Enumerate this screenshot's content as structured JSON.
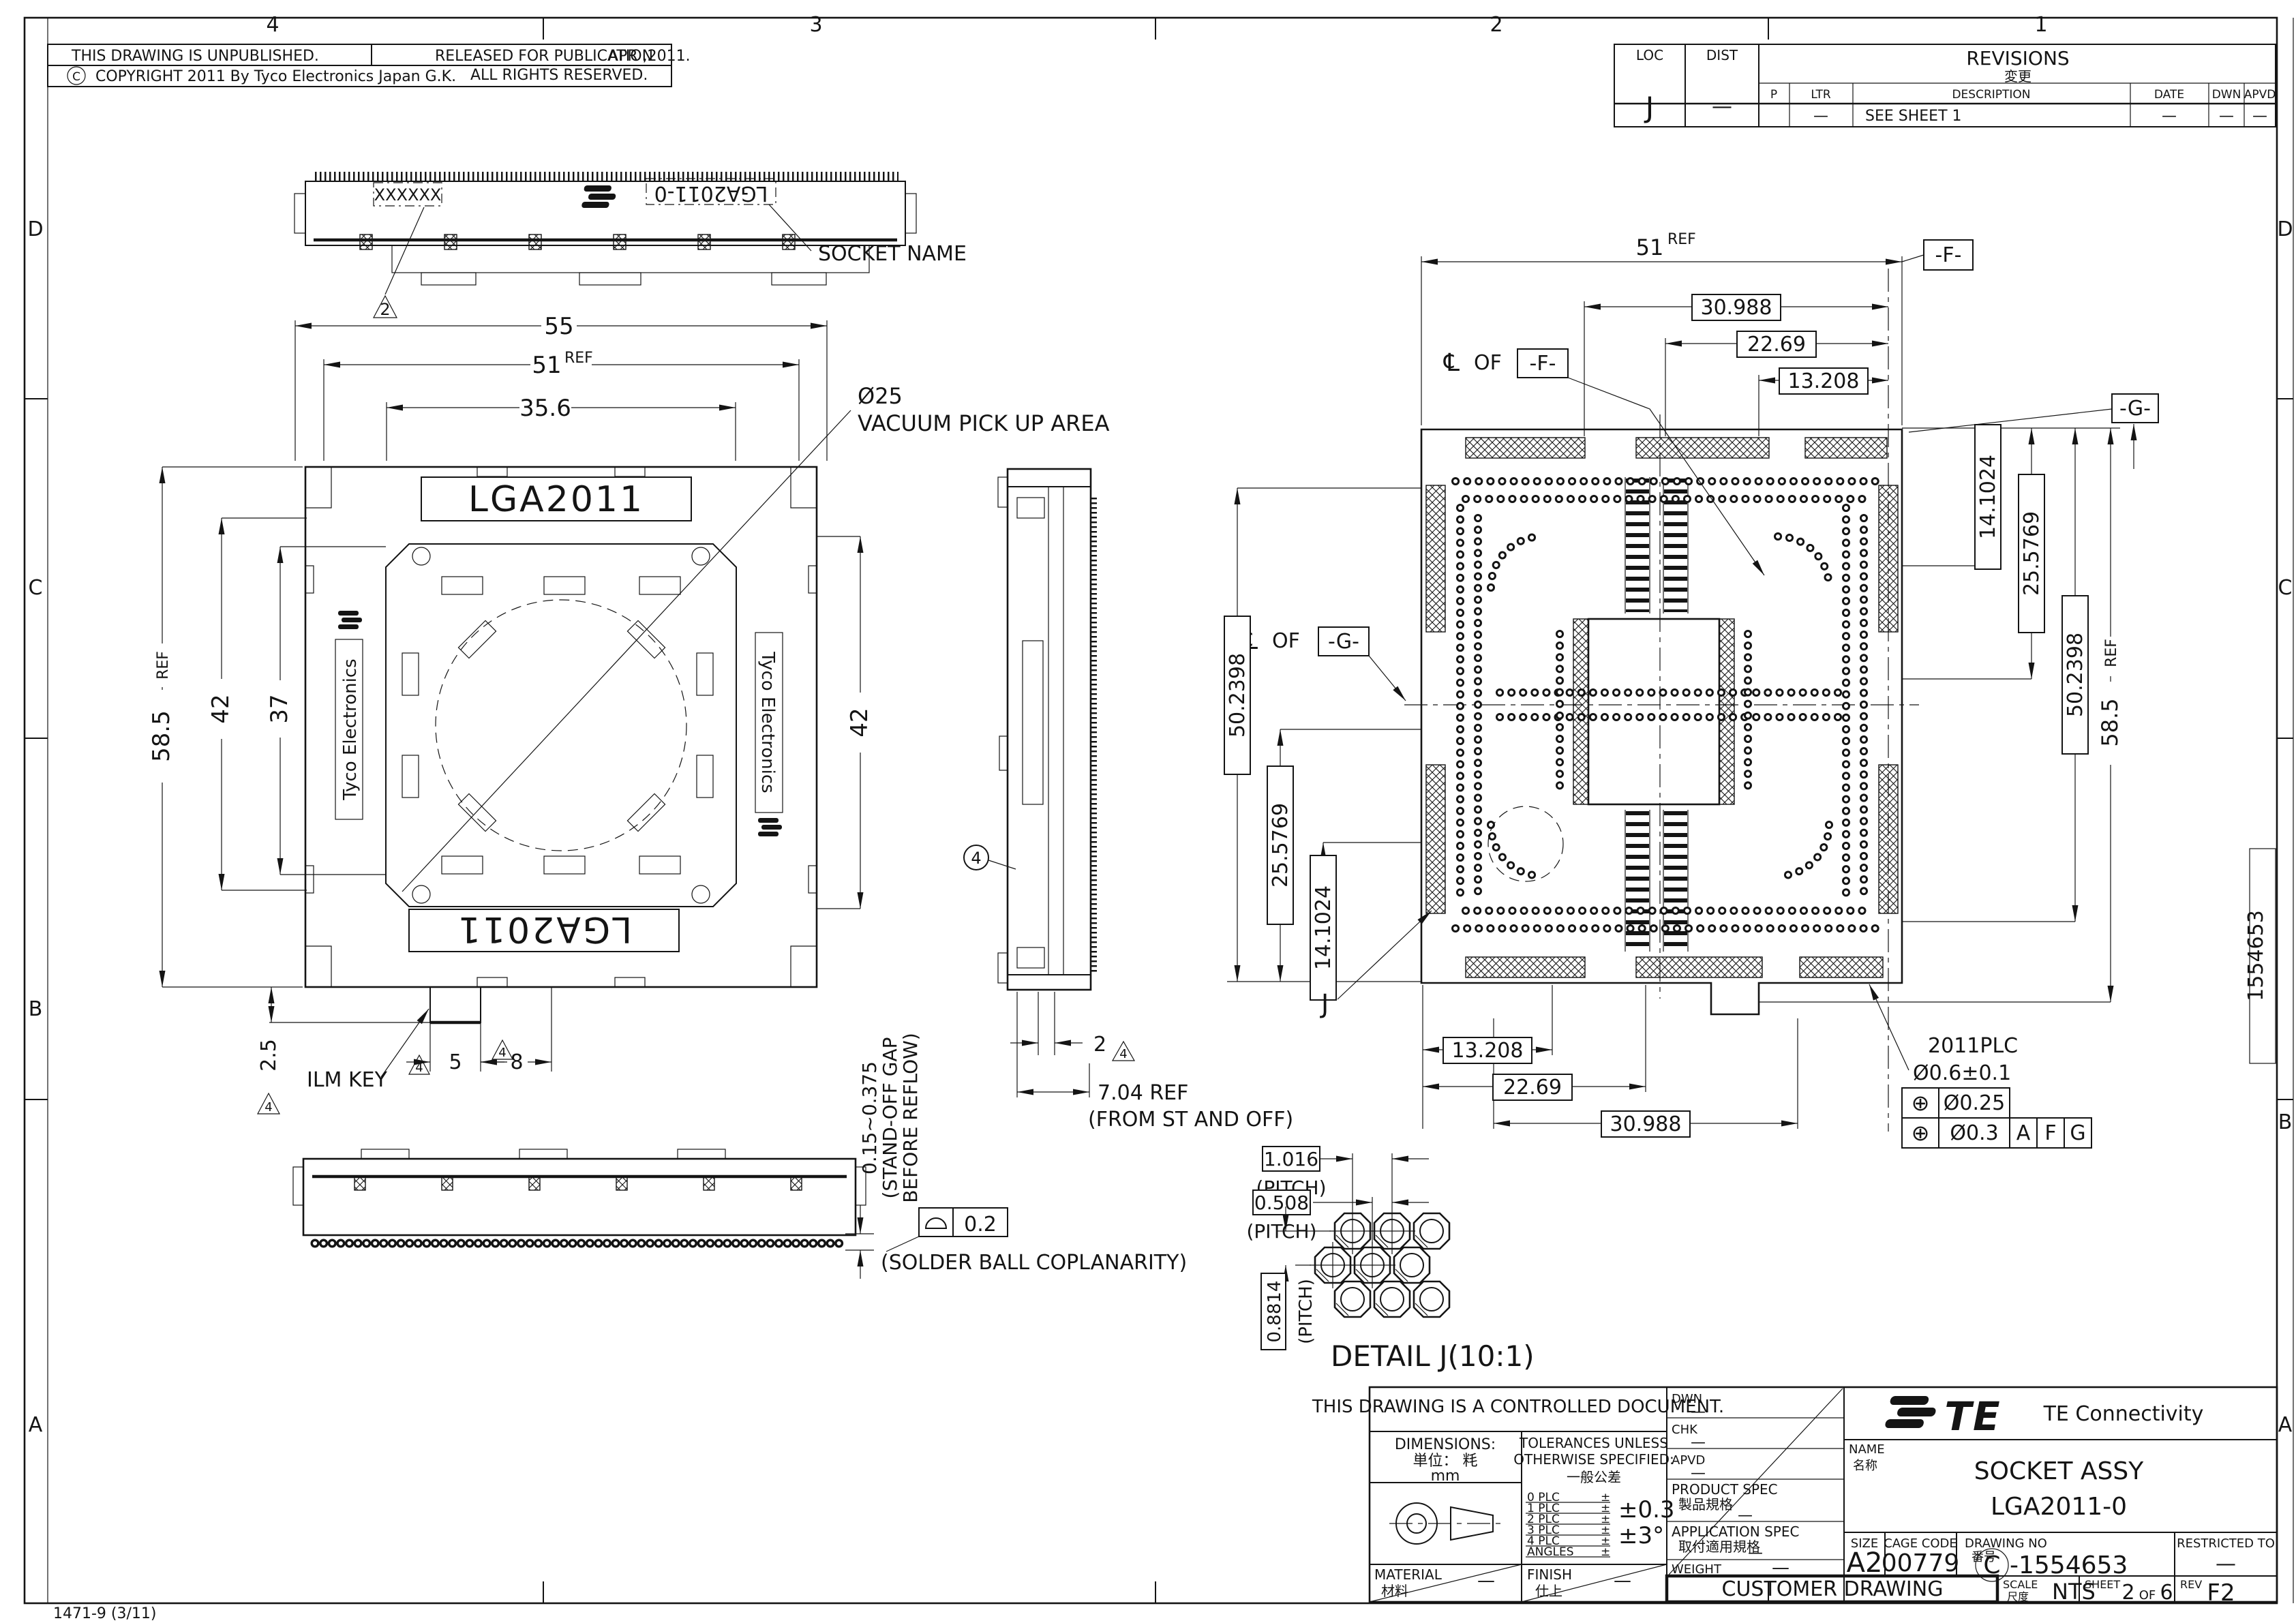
{
  "frame": {
    "zones_top": [
      "4",
      "3",
      "2",
      "1"
    ],
    "zones_left": [
      "D",
      "C",
      "B",
      "A"
    ],
    "zones_right": [
      "D",
      "C",
      "B",
      "A"
    ],
    "footer_code": "1471-9  (3/11)",
    "margin_number": "1554653"
  },
  "header": {
    "unpublished": "THIS DRAWING IS UNPUBLISHED.",
    "released": "RELEASED FOR PUBLICATION",
    "date": "APR ,2011.",
    "copyright_symbol": "C",
    "copyright": "COPYRIGHT  2011  By Tyco Electronics Japan G.K.",
    "rights": "ALL RIGHTS RESERVED."
  },
  "revisions": {
    "loc_label": "LOC",
    "loc_value": "J",
    "dist_label": "DIST",
    "dist_value": "—",
    "title": "REVISIONS",
    "title_jp": "変更",
    "col_p": "P",
    "col_ltr": "LTR",
    "col_description": "DESCRIPTION",
    "col_date": "DATE",
    "col_dwn": "DWN",
    "col_apvd": "APVD",
    "row_ltr": "—",
    "row_description": "SEE SHEET 1",
    "row_date": "—",
    "row_dwn": "—",
    "row_apvd": "—"
  },
  "views": {
    "marking": {
      "mark_x": "XXXXXX",
      "mark_name": "LGA2011-0",
      "socket_name_label": "SOCKET NAME",
      "note2": "2"
    },
    "front": {
      "dim_overall_w": "55",
      "dim_body_w": "51",
      "ref": "REF",
      "dim_pick_w": "35.6",
      "pick_dia": "Ø25",
      "pick_label": "VACUUM PICK UP AREA",
      "lga": "LGA2011",
      "brand": "Tyco Electronics",
      "dim_overall_h": "58.5",
      "dim_h1": "42",
      "dim_h2": "37",
      "dim_right_h": "42",
      "ilm_key": "ILM KEY",
      "dim_key_h": "2.5",
      "dim_key_w1": "5",
      "dim_key_w2": "8",
      "note4": "4"
    },
    "side": {
      "balloon4": "4",
      "dim_pin": "2",
      "note4": "4",
      "dim_standoff": "7.04 REF",
      "dim_standoff_note": "(FROM ST AND OFF)"
    },
    "reflow": {
      "standoff_range": "0.15~0.375",
      "standoff_note1": "(STAND-OFF GAP",
      "standoff_note2": "BEFORE REFLOW)",
      "coplanarity": "0.2",
      "coplanarity_note": "(SOLDER BALL COPLANARITY)"
    },
    "bottom": {
      "dim_w": "51",
      "ref": "REF",
      "datum_f": "-F-",
      "datum_g": "-G-",
      "cl": "℄",
      "of": "OF",
      "dim_t1": "30.988",
      "dim_t2": "22.69",
      "dim_t3": "13.208",
      "dim_l1": "50.2398",
      "dim_l2": "25.5769",
      "dim_l3": "14.1024",
      "dim_r1": "14.1024",
      "dim_r2": "25.5769",
      "dim_r3": "50.2398",
      "dim_r4": "58.5",
      "dim_b1": "13.208",
      "dim_b2": "22.69",
      "dim_b3": "30.988",
      "plc": "2011PLC",
      "hole": "Ø0.6±0.1",
      "pos_sym": "⊕",
      "tol1": "Ø0.25",
      "tol2": "Ø0.3",
      "d_a": "A",
      "d_f": "F",
      "d_g": "G",
      "detail_ref": "J"
    },
    "detail_j": {
      "p1": "1.016",
      "p2": "0.508",
      "p3": "0.8814",
      "pitch": "(PITCH)",
      "title": "DETAIL J(10:1)"
    }
  },
  "title_block": {
    "controlled": "THIS DRAWING IS A CONTROLLED DOCUMENT.",
    "dims_label": "DIMENSIONS:",
    "dims_jp": "単位： 粍",
    "dims_unit": "mm",
    "tol1": "TOLERANCES UNLESS",
    "tol2": "OTHERWISE SPECIFIED:",
    "tol_jp": "一般公差",
    "tol_rows": [
      {
        "label": "0 PLC",
        "pm": "±"
      },
      {
        "label": "1 PLC",
        "pm": "±"
      },
      {
        "label": "2 PLC",
        "pm": "±"
      },
      {
        "label": "3 PLC",
        "pm": "±"
      },
      {
        "label": "4 PLC",
        "pm": "±"
      },
      {
        "label": "ANGLES",
        "pm": "±"
      }
    ],
    "tol_v1": "±0.3",
    "tol_v2": "±3°",
    "material_label": "MATERIAL",
    "material_jp": "材料",
    "material_value": "—",
    "finish_label": "FINISH",
    "finish_jp": "仕上",
    "finish_value": "—",
    "dwn_label": "DWN",
    "dwn_value": "—",
    "chk_label": "CHK",
    "chk_value": "—",
    "apvd_label": "APVD",
    "apvd_value": "—",
    "product_label": "PRODUCT SPEC",
    "product_jp": "製品規格",
    "product_value": "—",
    "application_label": "APPLICATION SPEC",
    "application_jp": "取付適用規格",
    "application_value": "—",
    "weight_label": "WEIGHT",
    "weight_value": "—",
    "customer_drawing": "CUSTOMER DRAWING",
    "logo_text": "TE",
    "brand": "TE  Connectivity",
    "name_label": "NAME",
    "name_jp": "名称",
    "name_line1": "SOCKET ASSY",
    "name_line2": "LGA2011-0",
    "size_label": "SIZE",
    "size_value": "A2",
    "cage_label": "CAGE CODE",
    "cage_value": "00779",
    "dwg_label": "DRAWING NO",
    "dwg_jp": "番号",
    "dwg_prefix": "C",
    "dwg_value": "-1554653",
    "restricted_label": "RESTRICTED TO",
    "restricted_value": "—",
    "scale_label": "SCALE",
    "scale_jp": "尺度",
    "scale_value": "NTS",
    "sheet_label": "SHEET",
    "sheet_no": "2",
    "sheet_of": "OF",
    "sheet_total": "6",
    "rev_label": "REV",
    "rev_value": "F2"
  }
}
